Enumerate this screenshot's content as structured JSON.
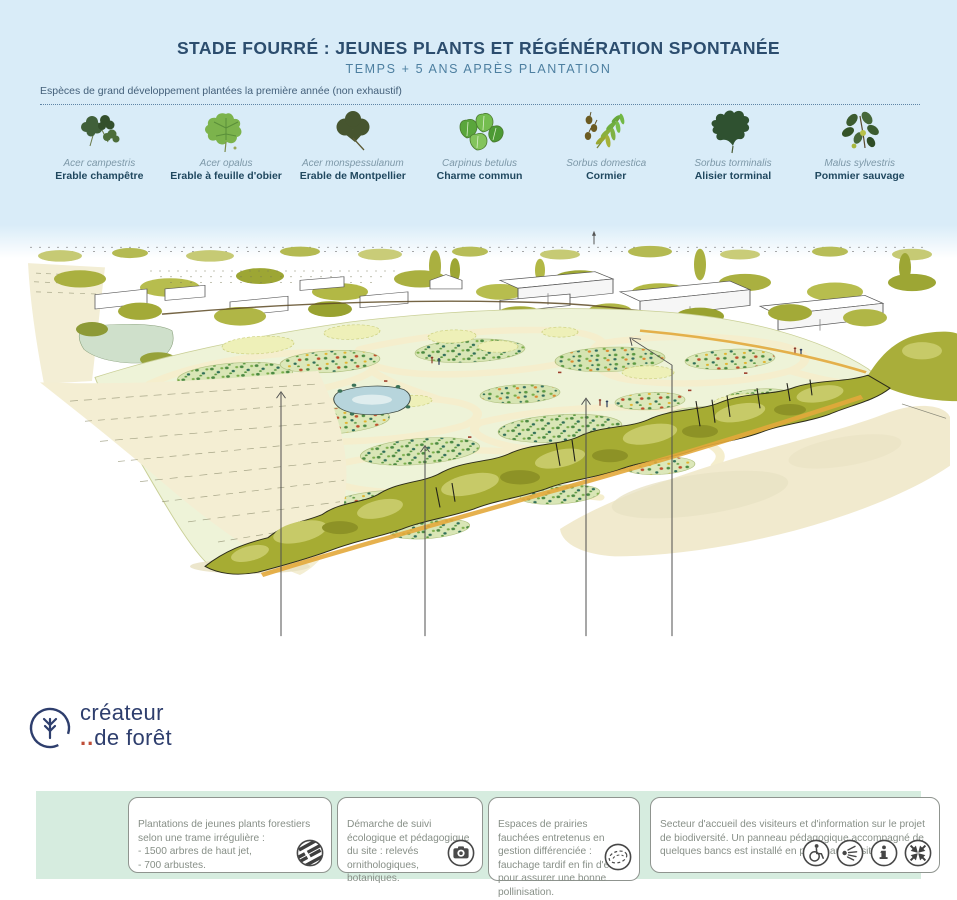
{
  "header": {
    "title": "STADE FOURRÉ : JEUNES PLANTS ET RÉGÉNÉRATION SPONTANÉE",
    "subtitle": "TEMPS + 5 ANS APRÈS PLANTATION",
    "species_note": "Espèces de grand développement plantées la première année (non exhaustif)"
  },
  "species": [
    {
      "latin": "Acer campestris",
      "common": "Erable champêtre",
      "icon": "field-maple-leaf"
    },
    {
      "latin": "Acer opalus",
      "common": "Erable à feuille d'obier",
      "icon": "italian-maple-leaf"
    },
    {
      "latin": "Acer monspessulanum",
      "common": "Erable de Montpellier",
      "icon": "montpellier-maple-leaf"
    },
    {
      "latin": "Carpinus betulus",
      "common": "Charme commun",
      "icon": "hornbeam-leaves"
    },
    {
      "latin": "Sorbus domestica",
      "common": "Cormier",
      "icon": "service-tree-leaf"
    },
    {
      "latin": "Sorbus torminalis",
      "common": "Alisier torminal",
      "icon": "wild-service-leaf"
    },
    {
      "latin": "Malus sylvestris",
      "common": "Pommier sauvage",
      "icon": "crab-apple-leaves"
    }
  ],
  "logo": {
    "line1": "créateur",
    "dots": "..",
    "line2": "de forêt"
  },
  "callouts": [
    {
      "text": "Plantations de jeunes plants forestiers selon une trame irrégulière :\n- 1500 arbres de haut jet,\n- 700 arbustes.",
      "icon": "striped-planting-pattern-icon"
    },
    {
      "text": "Démarche de suivi écologique et pédagogique du site : relevés ornithologiques, botaniques.",
      "icon": "camera-icon"
    },
    {
      "text": "Espaces de prairies fauchées entretenus en gestion différenciée : fauchage tardif en fin d'été pour assurer une bonne pollinisation.",
      "icon": "mown-meadow-icon"
    },
    {
      "text": "Secteur d'accueil des visiteurs et d'information sur le projet de biodiversité. Un panneau pédagogique accompagné de quelques bancs est installé en point haut du site.",
      "icons": [
        "wheelchair-access-icon",
        "viewpoint-rays-icon",
        "info-icon",
        "converging-arrows-icon"
      ]
    }
  ],
  "colors": {
    "header_bg": "#d9ecf8",
    "title": "#2c4d6e",
    "subtitle": "#4d7fa0",
    "footer_band": "#d6ecdf",
    "hedge_olive": "#a6ac33",
    "field_green": "#eef3d8",
    "path_cream": "#f5eecd",
    "beige_field": "#f4eed3",
    "logo_navy": "#2e3e6d",
    "accent_orange": "#e3a83b"
  }
}
